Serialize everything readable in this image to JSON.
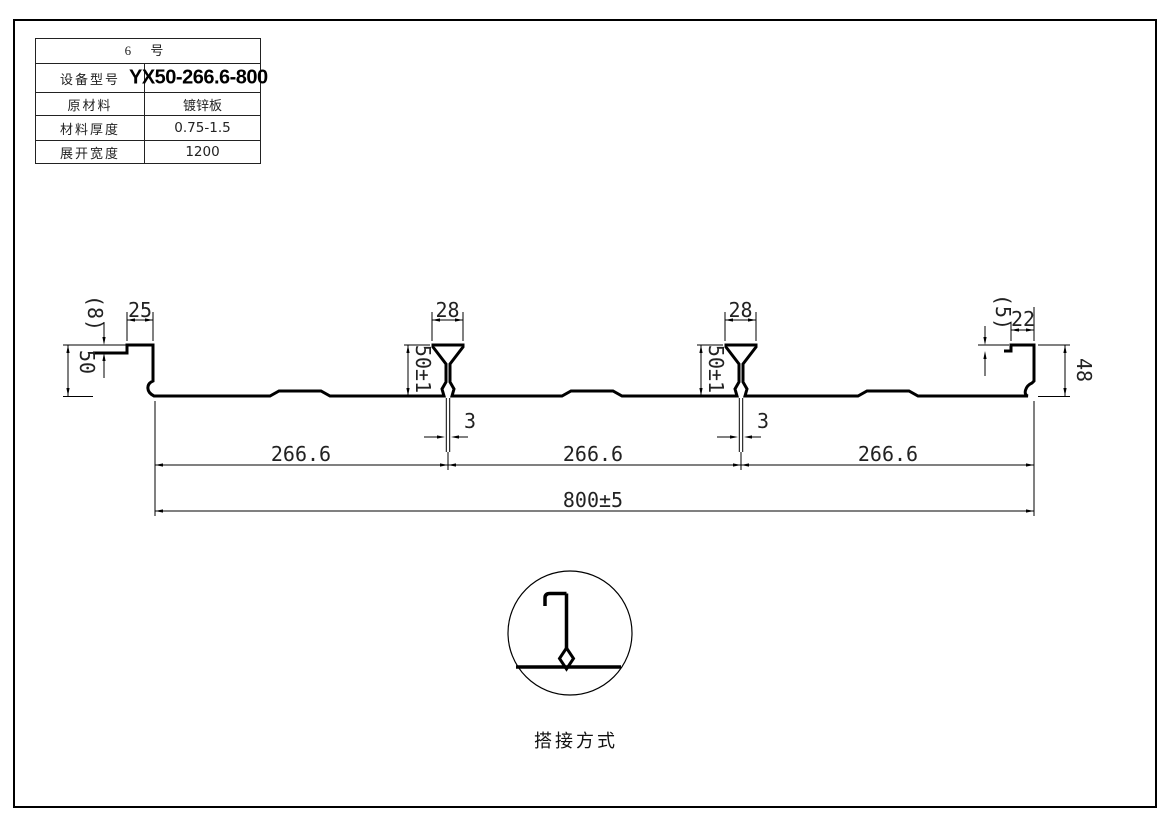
{
  "spec_table": {
    "title": "6 号",
    "rows": [
      {
        "label": "设备型号",
        "value": "YX50-266.6-800"
      },
      {
        "label": "原材料",
        "value": "镀锌板"
      },
      {
        "label": "材料厚度",
        "value": "0.75-1.5"
      },
      {
        "label": "展开宽度",
        "value": "1200"
      }
    ]
  },
  "dims": {
    "left_lip": "(8)",
    "left_flange": "25",
    "left_height": "50",
    "rib1_top": "28",
    "rib1_height": "50±1",
    "rib1_stem": "3",
    "rib2_top": "28",
    "rib2_height": "50±1",
    "rib2_stem": "3",
    "right_lip": "(5)",
    "right_flange": "22",
    "right_height": "48",
    "span1": "266.6",
    "span2": "266.6",
    "span3": "266.6",
    "overall": "800±5"
  },
  "detail": {
    "label": "搭接方式"
  }
}
